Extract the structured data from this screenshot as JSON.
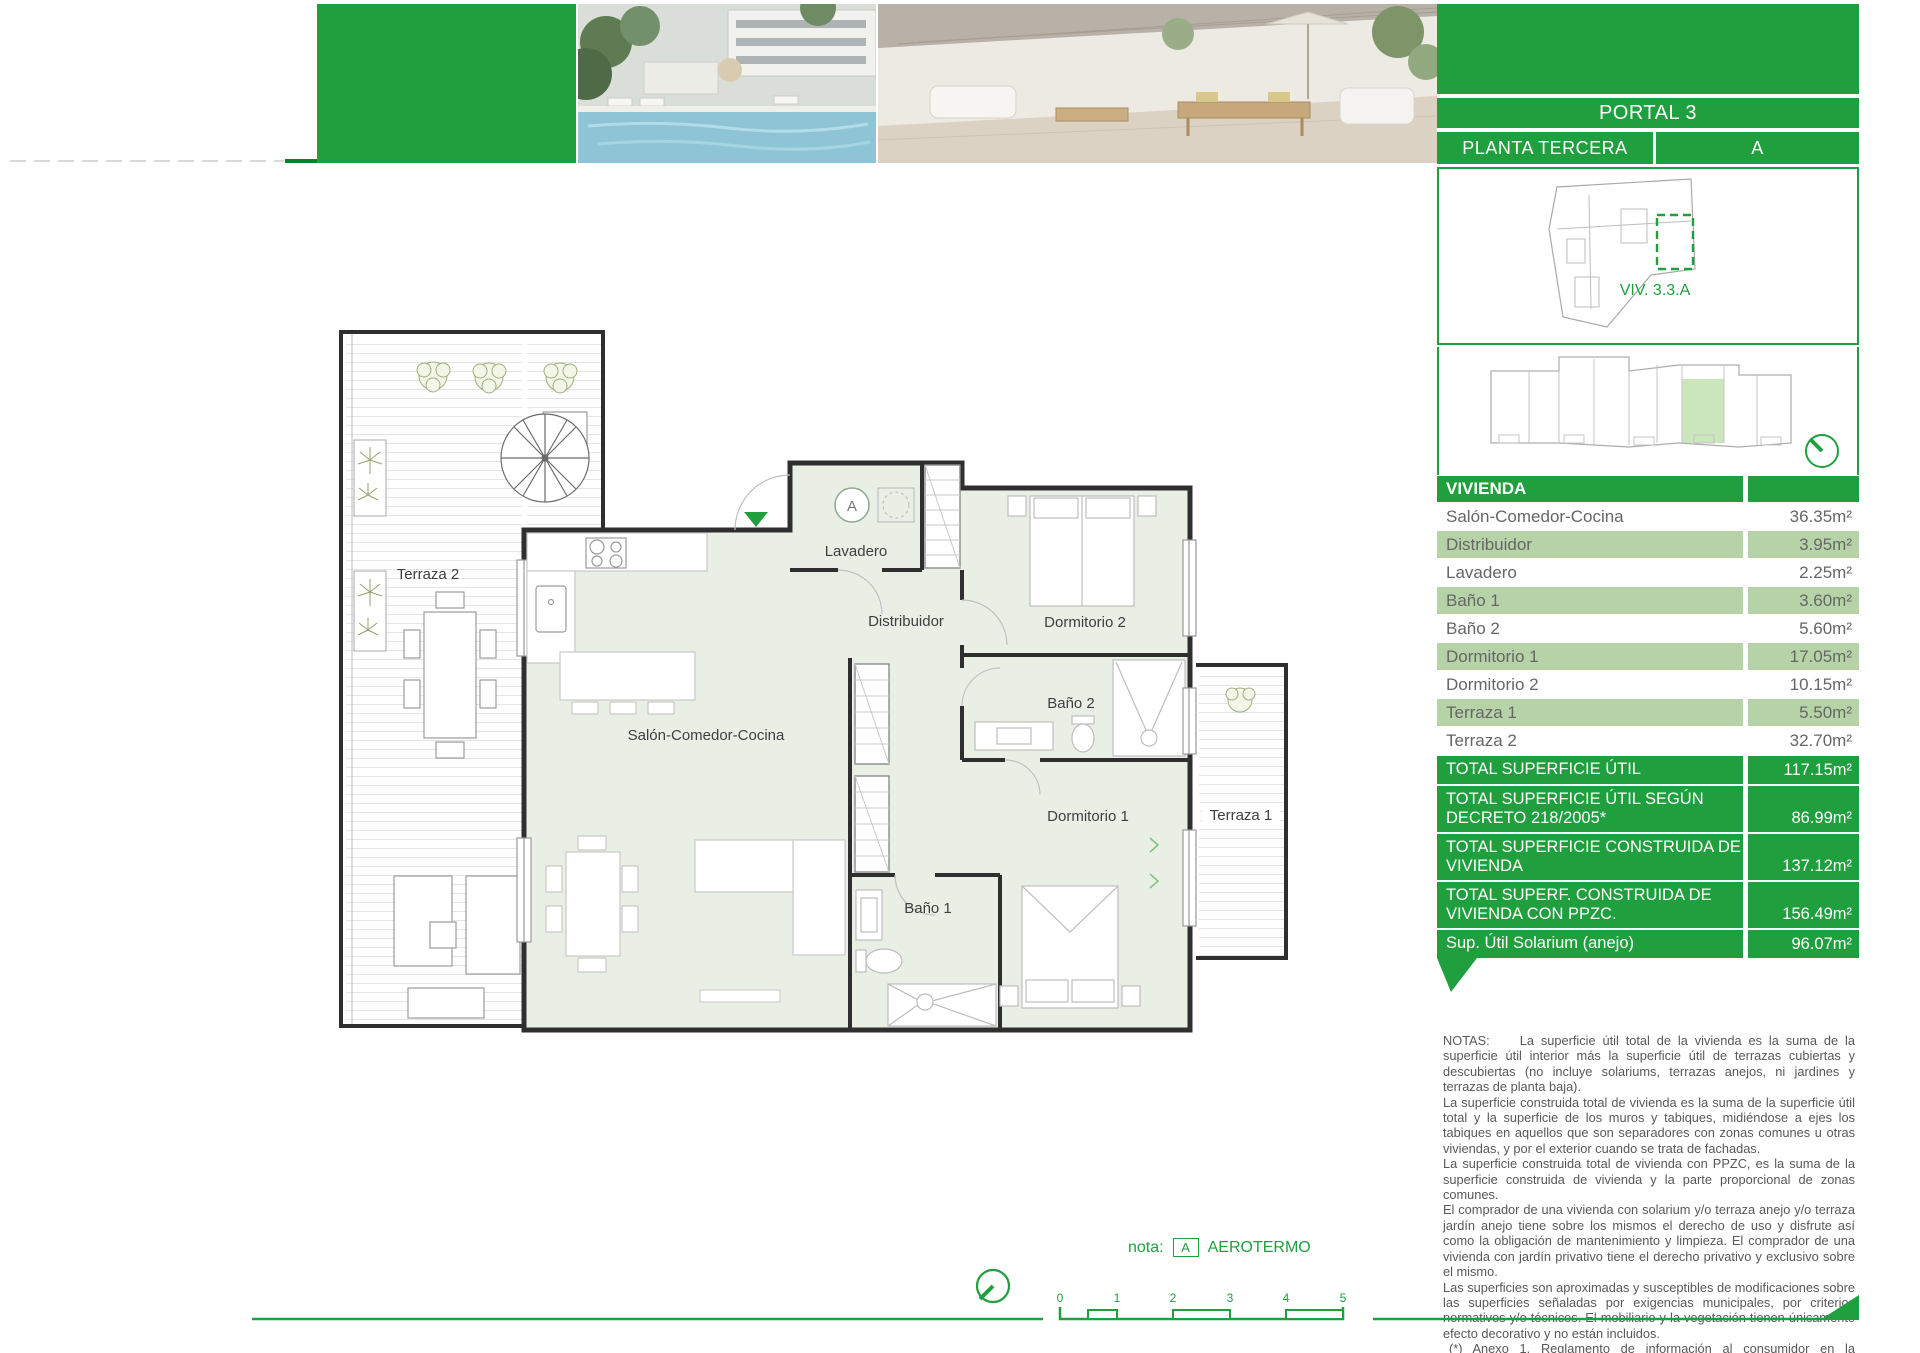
{
  "colors": {
    "green": "#1F9F3E",
    "row_green": "#B6D3A8",
    "room_fill": "#E9EFE5",
    "key_highlight": "#CBE5BD"
  },
  "header": {
    "portal": "PORTAL 3",
    "planta": "PLANTA TERCERA",
    "unit_letter": "A",
    "viv_code": "VIV. 3.3.A"
  },
  "table": {
    "header": "VIVIENDA",
    "rows": [
      {
        "label": "Salón-Comedor-Cocina",
        "value": "36.35m²"
      },
      {
        "label": "Distribuidor",
        "value": "3.95m²"
      },
      {
        "label": "Lavadero",
        "value": "2.25m²"
      },
      {
        "label": "Baño 1",
        "value": "3.60m²"
      },
      {
        "label": "Baño 2",
        "value": "5.60m²"
      },
      {
        "label": "Dormitorio 1",
        "value": "17.05m²"
      },
      {
        "label": "Dormitorio 2",
        "value": "10.15m²"
      },
      {
        "label": "Terraza 1",
        "value": "5.50m²"
      },
      {
        "label": "Terraza 2",
        "value": "32.70m²"
      }
    ],
    "totals": [
      {
        "label": "TOTAL SUPERFICIE ÚTIL",
        "value": "117.15m²"
      },
      {
        "label": "TOTAL SUPERFICIE ÚTIL SEGÚN DECRETO 218/2005*",
        "value": "86.99m²"
      },
      {
        "label": "TOTAL SUPERFICIE CONSTRUIDA DE VIVIENDA",
        "value": "137.12m²"
      },
      {
        "label": "TOTAL SUPERF. CONSTRUIDA DE VIVIENDA CON PPZC.",
        "value": "156.49m²"
      },
      {
        "label": "Sup. Útil Solarium (anejo)",
        "value": "96.07m²"
      }
    ]
  },
  "plan": {
    "rooms": {
      "terraza2": "Terraza 2",
      "salon": "Salón-Comedor-Cocina",
      "distribuidor": "Distribuidor",
      "lavadero": "Lavadero",
      "dormitorio2": "Dormitorio 2",
      "bano2": "Baño 2",
      "dormitorio1": "Dormitorio 1",
      "bano1": "Baño 1",
      "terraza1": "Terraza 1"
    },
    "aerotermo_marker": "A"
  },
  "notes": {
    "label": "NOTAS:",
    "paragraphs": [
      "La superficie útil total de la vivienda es la suma de la superficie útil interior más la superficie útil de terrazas cubiertas y descubiertas (no incluye solariums, terrazas anejos, ni jardines y terrazas de planta baja).",
      "La superficie construida total de vivienda es la suma de la superficie útil total y la superficie de los muros y tabiques, midiéndose a ejes los tabiques en aquellos que son separadores con zonas comunes u otras viviendas, y por el exterior cuando se trata de fachadas.",
      "La superficie construida total de vivienda con PPZC, es la suma de la superficie construida de vivienda y la parte proporcional de zonas comunes.",
      "El comprador de una vivienda con solarium y/o terraza anejo y/o terraza jardín anejo tiene sobre los mismos el derecho de uso y disfrute así como la obligación de mantenimiento y limpieza. El comprador de una vivienda con jardín privativo tiene el derecho privativo y exclusivo sobre el mismo.",
      "Las superficies son aproximadas y susceptibles de modificaciones sobre las superficies señaladas por exigencias municipales, por criterios normativos y/o técnicos. El mobiliario y la vegetación tienen únicamente efecto decorativo y no están incluidos.",
      "(*) Anexo 1. Reglamento de información al consumidor en la compraventa y arrendamiento de viviendas en Andalucía."
    ]
  },
  "footer": {
    "nota_label": "nota:",
    "aerotermo_box": "A",
    "aerotermo_text": "AEROTERMO"
  },
  "scalebar": {
    "ticks": [
      "0",
      "1",
      "2",
      "3",
      "4",
      "5"
    ]
  }
}
